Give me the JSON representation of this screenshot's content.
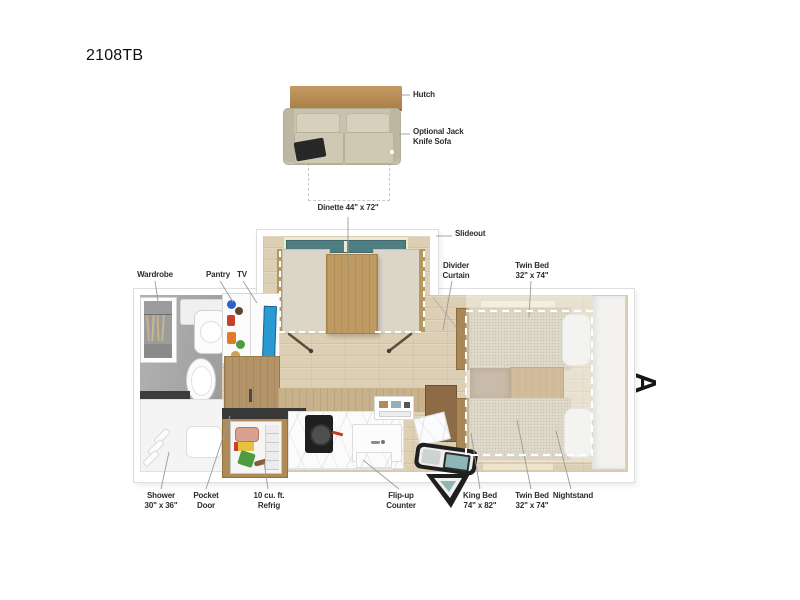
{
  "title": "2108TB",
  "marker": "A",
  "callouts": {
    "hutch": "Hutch",
    "sofa": "Optional Jack\nKnife Sofa",
    "dinette": "Dinette 44\" x 72\"",
    "slideout": "Slideout",
    "divider_curtain": "Divider\nCurtain",
    "twin_bed_top": "Twin Bed\n32\" x 74\"",
    "wardrobe": "Wardrobe",
    "pantry": "Pantry",
    "tv": "TV",
    "shower": "Shower\n30\" x 36\"",
    "pocket_door": "Pocket\nDoor",
    "refrigerator": "10 cu. ft.\nRefrig",
    "flip_up_counter": "Flip-up\nCounter",
    "king_bed": "King Bed\n74\" x 82\"",
    "twin_bed_bottom": "Twin Bed\n32\" x 74\"",
    "nightstand": "Nightstand"
  },
  "colors": {
    "wood_hutch": "#b5854e",
    "wood_table": "#bd9a62",
    "wood_cabinet": "#b08b58",
    "wood_dark": "#8d6b46",
    "sofa_beige": "#cdc6b2",
    "bench_beige": "#dbd6c8",
    "mattress_beige": "#cdc3aa",
    "pillow_white": "#ececea",
    "floor_wood": "#dccfb4",
    "bath_floor_gray": "#a8a8a8",
    "window_teal": "#4e7d82",
    "tv_blue": "#2a9ad2",
    "marble_white": "#fbfbfb",
    "counter_dark": "#383838",
    "door_black": "#202020",
    "step_teal": "#8fb6b6",
    "label_text": "#2d2d2d",
    "leader_line": "#9b9b9b",
    "conversion_dash": "#ffffff"
  }
}
